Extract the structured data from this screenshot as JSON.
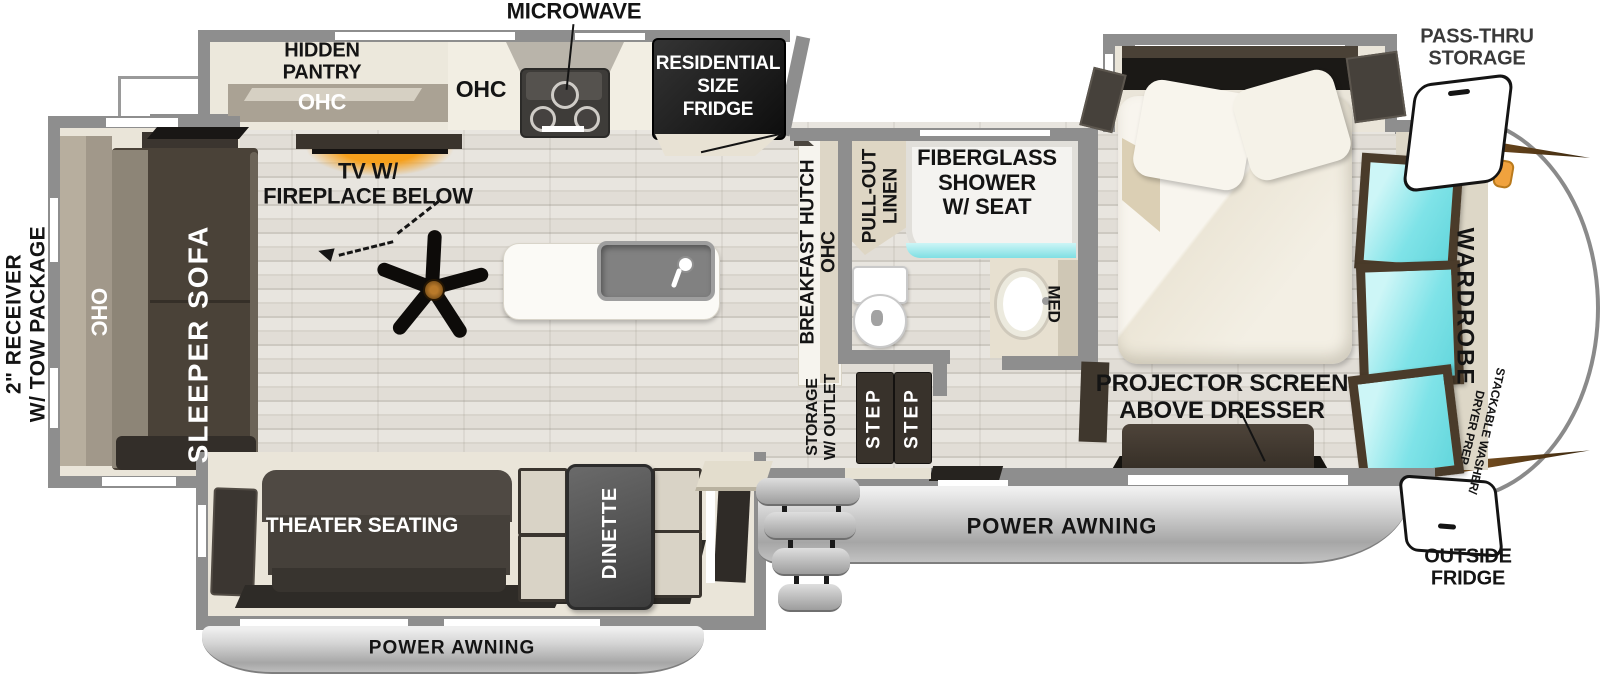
{
  "title": "Fifth-wheel RV floor plan",
  "colors": {
    "wall": "#8e8e8e",
    "floor_wood": "#e1ded7",
    "slide_beige": "#eae5d9",
    "furniture_dark": "#453f37",
    "fridge_black": "#161616",
    "window_cyan": "#7fe3e8",
    "tv_glow_orange": "#f6a01c",
    "awning_silver": "#c6c6c6",
    "cap_accent_brown": "#7a4e1d"
  },
  "labels": {
    "microwave": "MICROWAVE",
    "hidden_pantry": [
      "HIDDEN",
      "PANTRY"
    ],
    "pantry_ohc": "OHC",
    "kitchen_ohc": "OHC",
    "fridge": [
      "RESIDENTIAL",
      "SIZE",
      "FRIDGE"
    ],
    "tv": [
      "TV W/",
      "FIREPLACE BELOW"
    ],
    "sleeper_sofa": "SLEEPER SOFA",
    "sofa_ohc": "OHC",
    "receiver": [
      "2\" RECEIVER",
      "W/ TOW PACKAGE"
    ],
    "breakfast_hutch": [
      "BREAKFAST HUTCH",
      "OHC"
    ],
    "pull_out_linen": [
      "PULL-OUT",
      "LINEN"
    ],
    "shower": [
      "FIBERGLASS",
      "SHOWER",
      "W/ SEAT"
    ],
    "med": "MED",
    "storage_outlet": [
      "STORAGE",
      "W/ OUTLET"
    ],
    "step": "STEP",
    "projector": [
      "PROJECTOR SCREEN",
      "ABOVE DRESSER"
    ],
    "pass_thru": [
      "PASS-THRU",
      "STORAGE"
    ],
    "wardrobe": "WARDROBE",
    "stackable": [
      "STACKABLE WASHER/",
      "DRYER PREP"
    ],
    "outside_fridge": [
      "OUTSIDE",
      "FRIDGE"
    ],
    "power_awning": "POWER AWNING",
    "theater_seating": "THEATER SEATING",
    "dinette": "DINETTE"
  }
}
